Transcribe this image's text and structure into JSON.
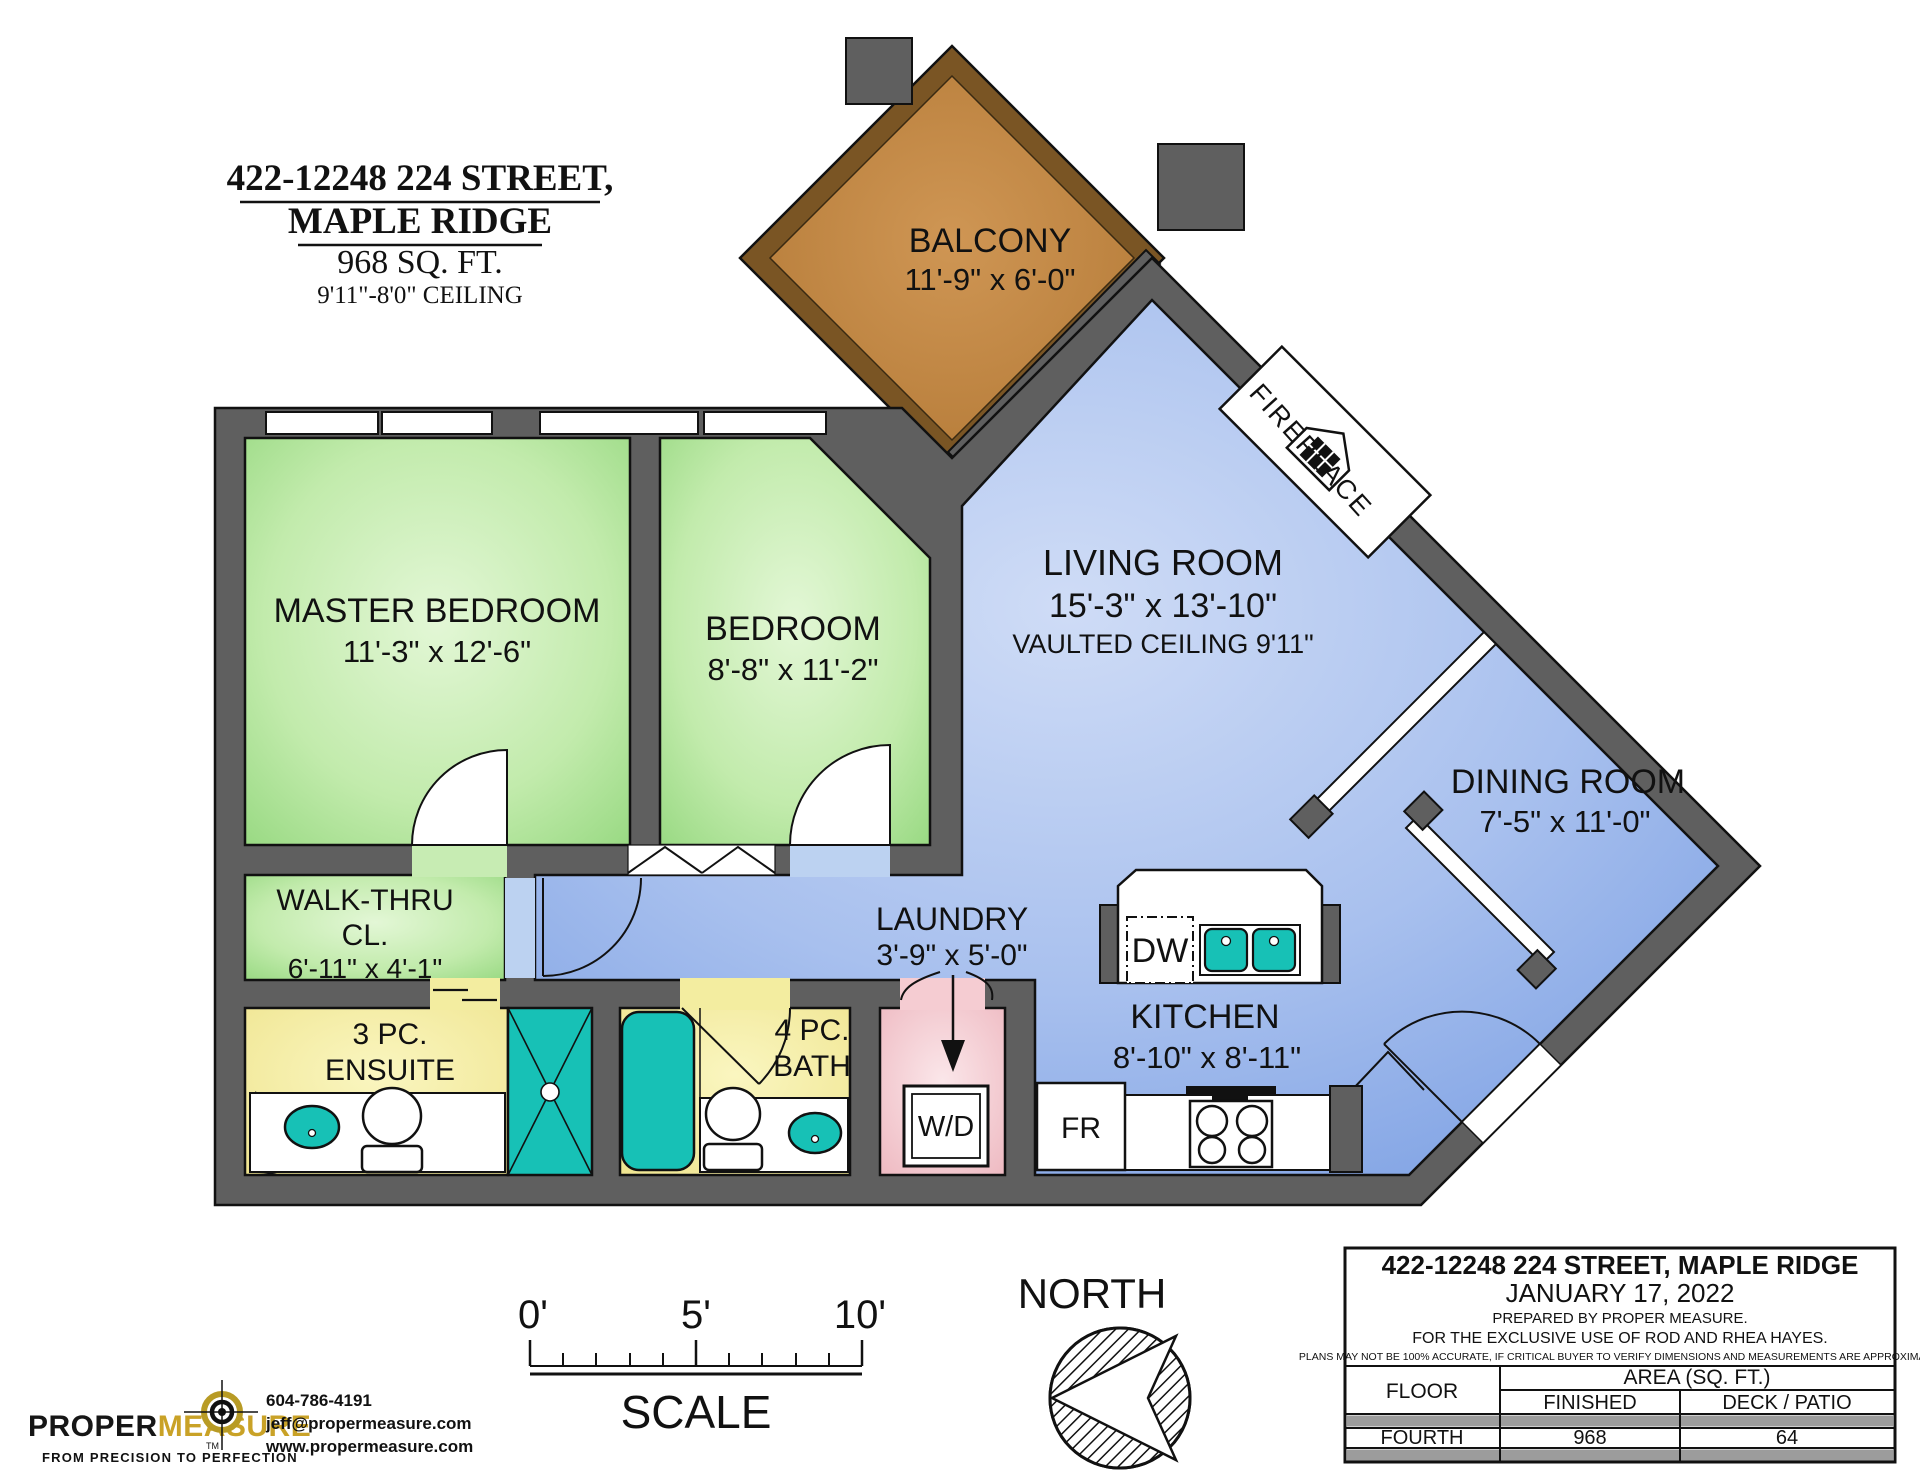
{
  "title": {
    "line1": "422-12248 224 STREET,",
    "line2": "MAPLE RIDGE",
    "line3": "968 SQ. FT.",
    "line4": "9'11\"-8'0\" CEILING"
  },
  "rooms": {
    "balcony": {
      "name": "BALCONY",
      "dims": "11'-9\" x 6'-0\""
    },
    "living": {
      "name": "LIVING ROOM",
      "dims": "15'-3\" x 13'-10\"",
      "note": "VAULTED CEILING 9'11\""
    },
    "dining": {
      "name": "DINING ROOM",
      "dims": "7'-5\" x 11'-0\""
    },
    "kitchen": {
      "name": "KITCHEN",
      "dims": "8'-10\" x 8'-11\""
    },
    "laundry": {
      "name": "LAUNDRY",
      "dims": "3'-9\" x 5'-0\""
    },
    "master": {
      "name": "MASTER BEDROOM",
      "dims": "11'-3\" x 12'-6\""
    },
    "bedroom": {
      "name": "BEDROOM",
      "dims": "8'-8\" x 11'-2\""
    },
    "walkthru": {
      "name1": "WALK-THRU",
      "name2": "CL.",
      "dims": "6'-11\" x 4'-1\""
    },
    "ensuite": {
      "name1": "3 PC.",
      "name2": "ENSUITE"
    },
    "bath": {
      "name1": "4 PC.",
      "name2": "BATH"
    },
    "fireplace": {
      "name": "FIREPLACE"
    }
  },
  "appliances": {
    "dw": "DW",
    "wd": "W/D",
    "fr": "FR"
  },
  "compass": {
    "label": "NORTH"
  },
  "scalebar": {
    "t0": "0'",
    "t5": "5'",
    "t10": "10'",
    "label": "SCALE"
  },
  "logo": {
    "part1": "PROPER",
    "part2": "MEASURE",
    "tm": "TM",
    "tagline": "FROM PRECISION TO PERFECTION",
    "phone": "604-786-4191",
    "email": "jeff@propermeasure.com",
    "website": "www.propermeasure.com"
  },
  "infobox": {
    "address": "422-12248 224 STREET, MAPLE RIDGE",
    "date": "JANUARY 17, 2022",
    "prepared": "PREPARED BY PROPER MEASURE.",
    "exclusive": "FOR THE EXCLUSIVE USE OF ROD AND RHEA HAYES.",
    "disclaimer": "PLANS MAY NOT BE 100% ACCURATE, IF CRITICAL BUYER TO VERIFY DIMENSIONS AND MEASUREMENTS ARE APPROXIMATE.",
    "table": {
      "col_floor": "FLOOR",
      "col_area": "AREA (SQ. FT.)",
      "col_finished": "FINISHED",
      "col_deck": "DECK / PATIO",
      "rows": [
        {
          "floor": "FOURTH",
          "finished": "968",
          "deck": "64"
        }
      ]
    }
  },
  "colors": {
    "wall_gray": "#5f5f5f",
    "living_blue": "#86a7e6",
    "bedroom_green": "#9fdb8a",
    "bath_yellow": "#f5efa4",
    "laundry_pink": "#f3c7ce",
    "balcony_brown": "#c08445",
    "fixture_teal": "#17c1b6",
    "logo_gold": "#c9a227"
  }
}
